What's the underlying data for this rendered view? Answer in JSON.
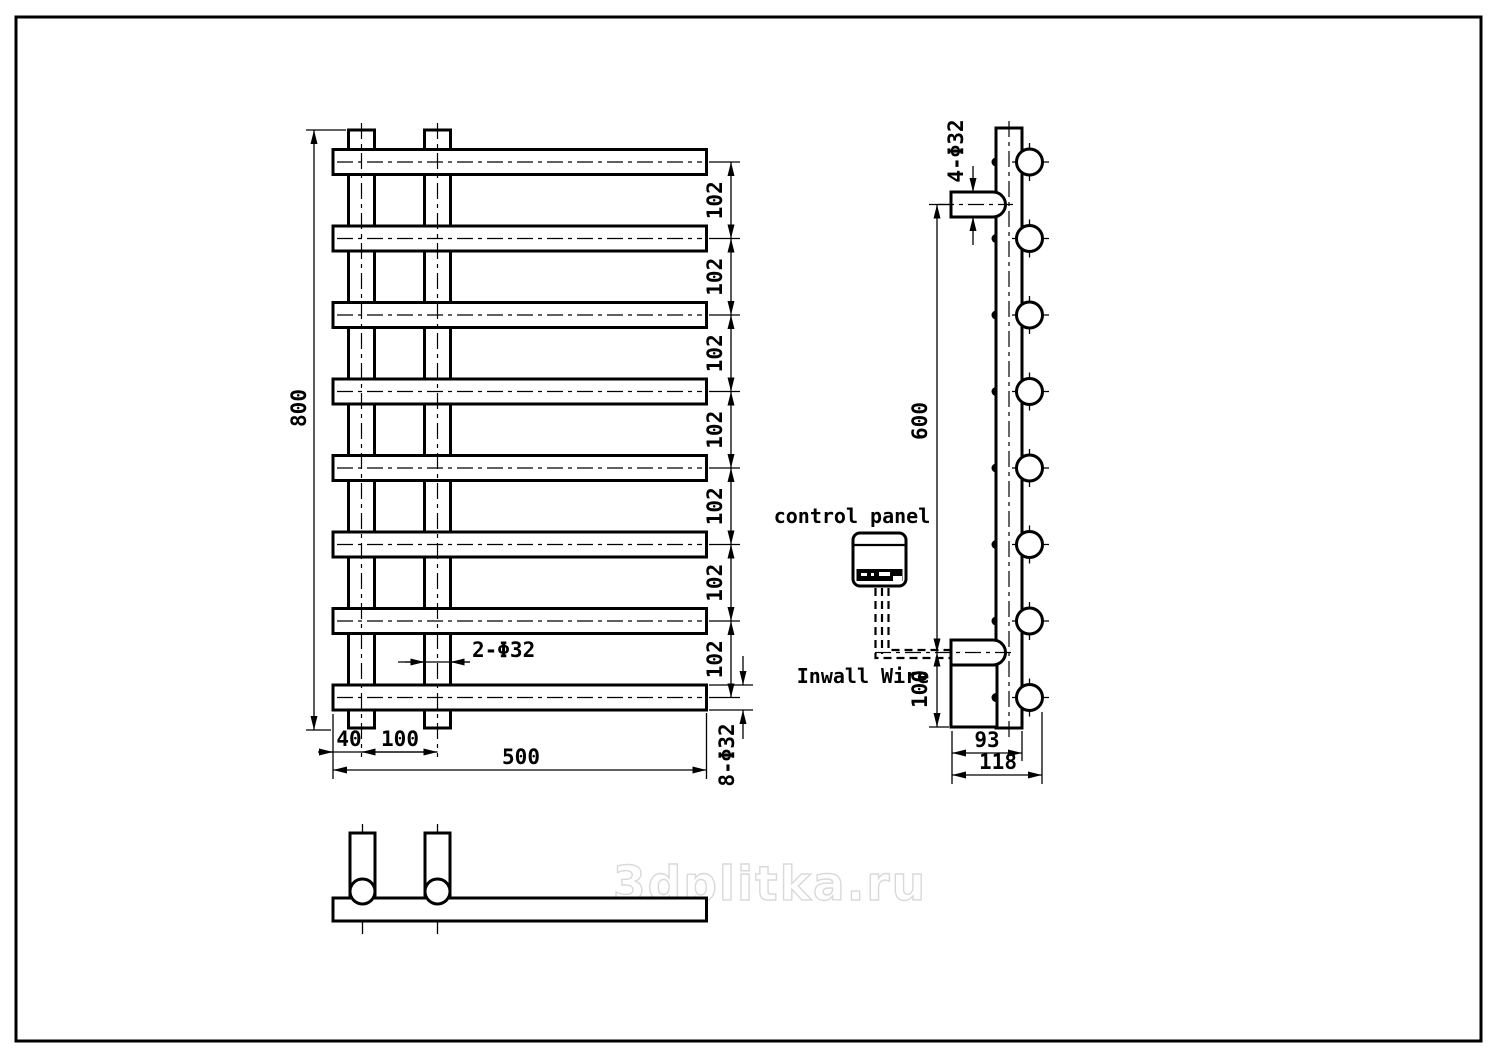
{
  "watermark": "3dplitka.ru",
  "front_view": {
    "height_label": "800",
    "spacing_labels": [
      "102",
      "102",
      "102",
      "102",
      "102",
      "102",
      "102"
    ],
    "post_diameter_label": "2-Φ32",
    "post_offset_label": "40",
    "post_spacing_label": "100",
    "width_label": "500",
    "bar_diameter_label": "8-Φ32"
  },
  "side_view": {
    "bracket_diameter_label": "4-Φ32",
    "bracket_span_label": "600",
    "bottom_offset_label": "100",
    "body_depth_label": "93",
    "overall_depth_label": "118",
    "control_panel_label": "control panel",
    "inwall_wire_label": "Inwall Wire"
  },
  "colors": {
    "line": "#000000",
    "background": "#ffffff",
    "watermark": "#d9d9d9"
  }
}
